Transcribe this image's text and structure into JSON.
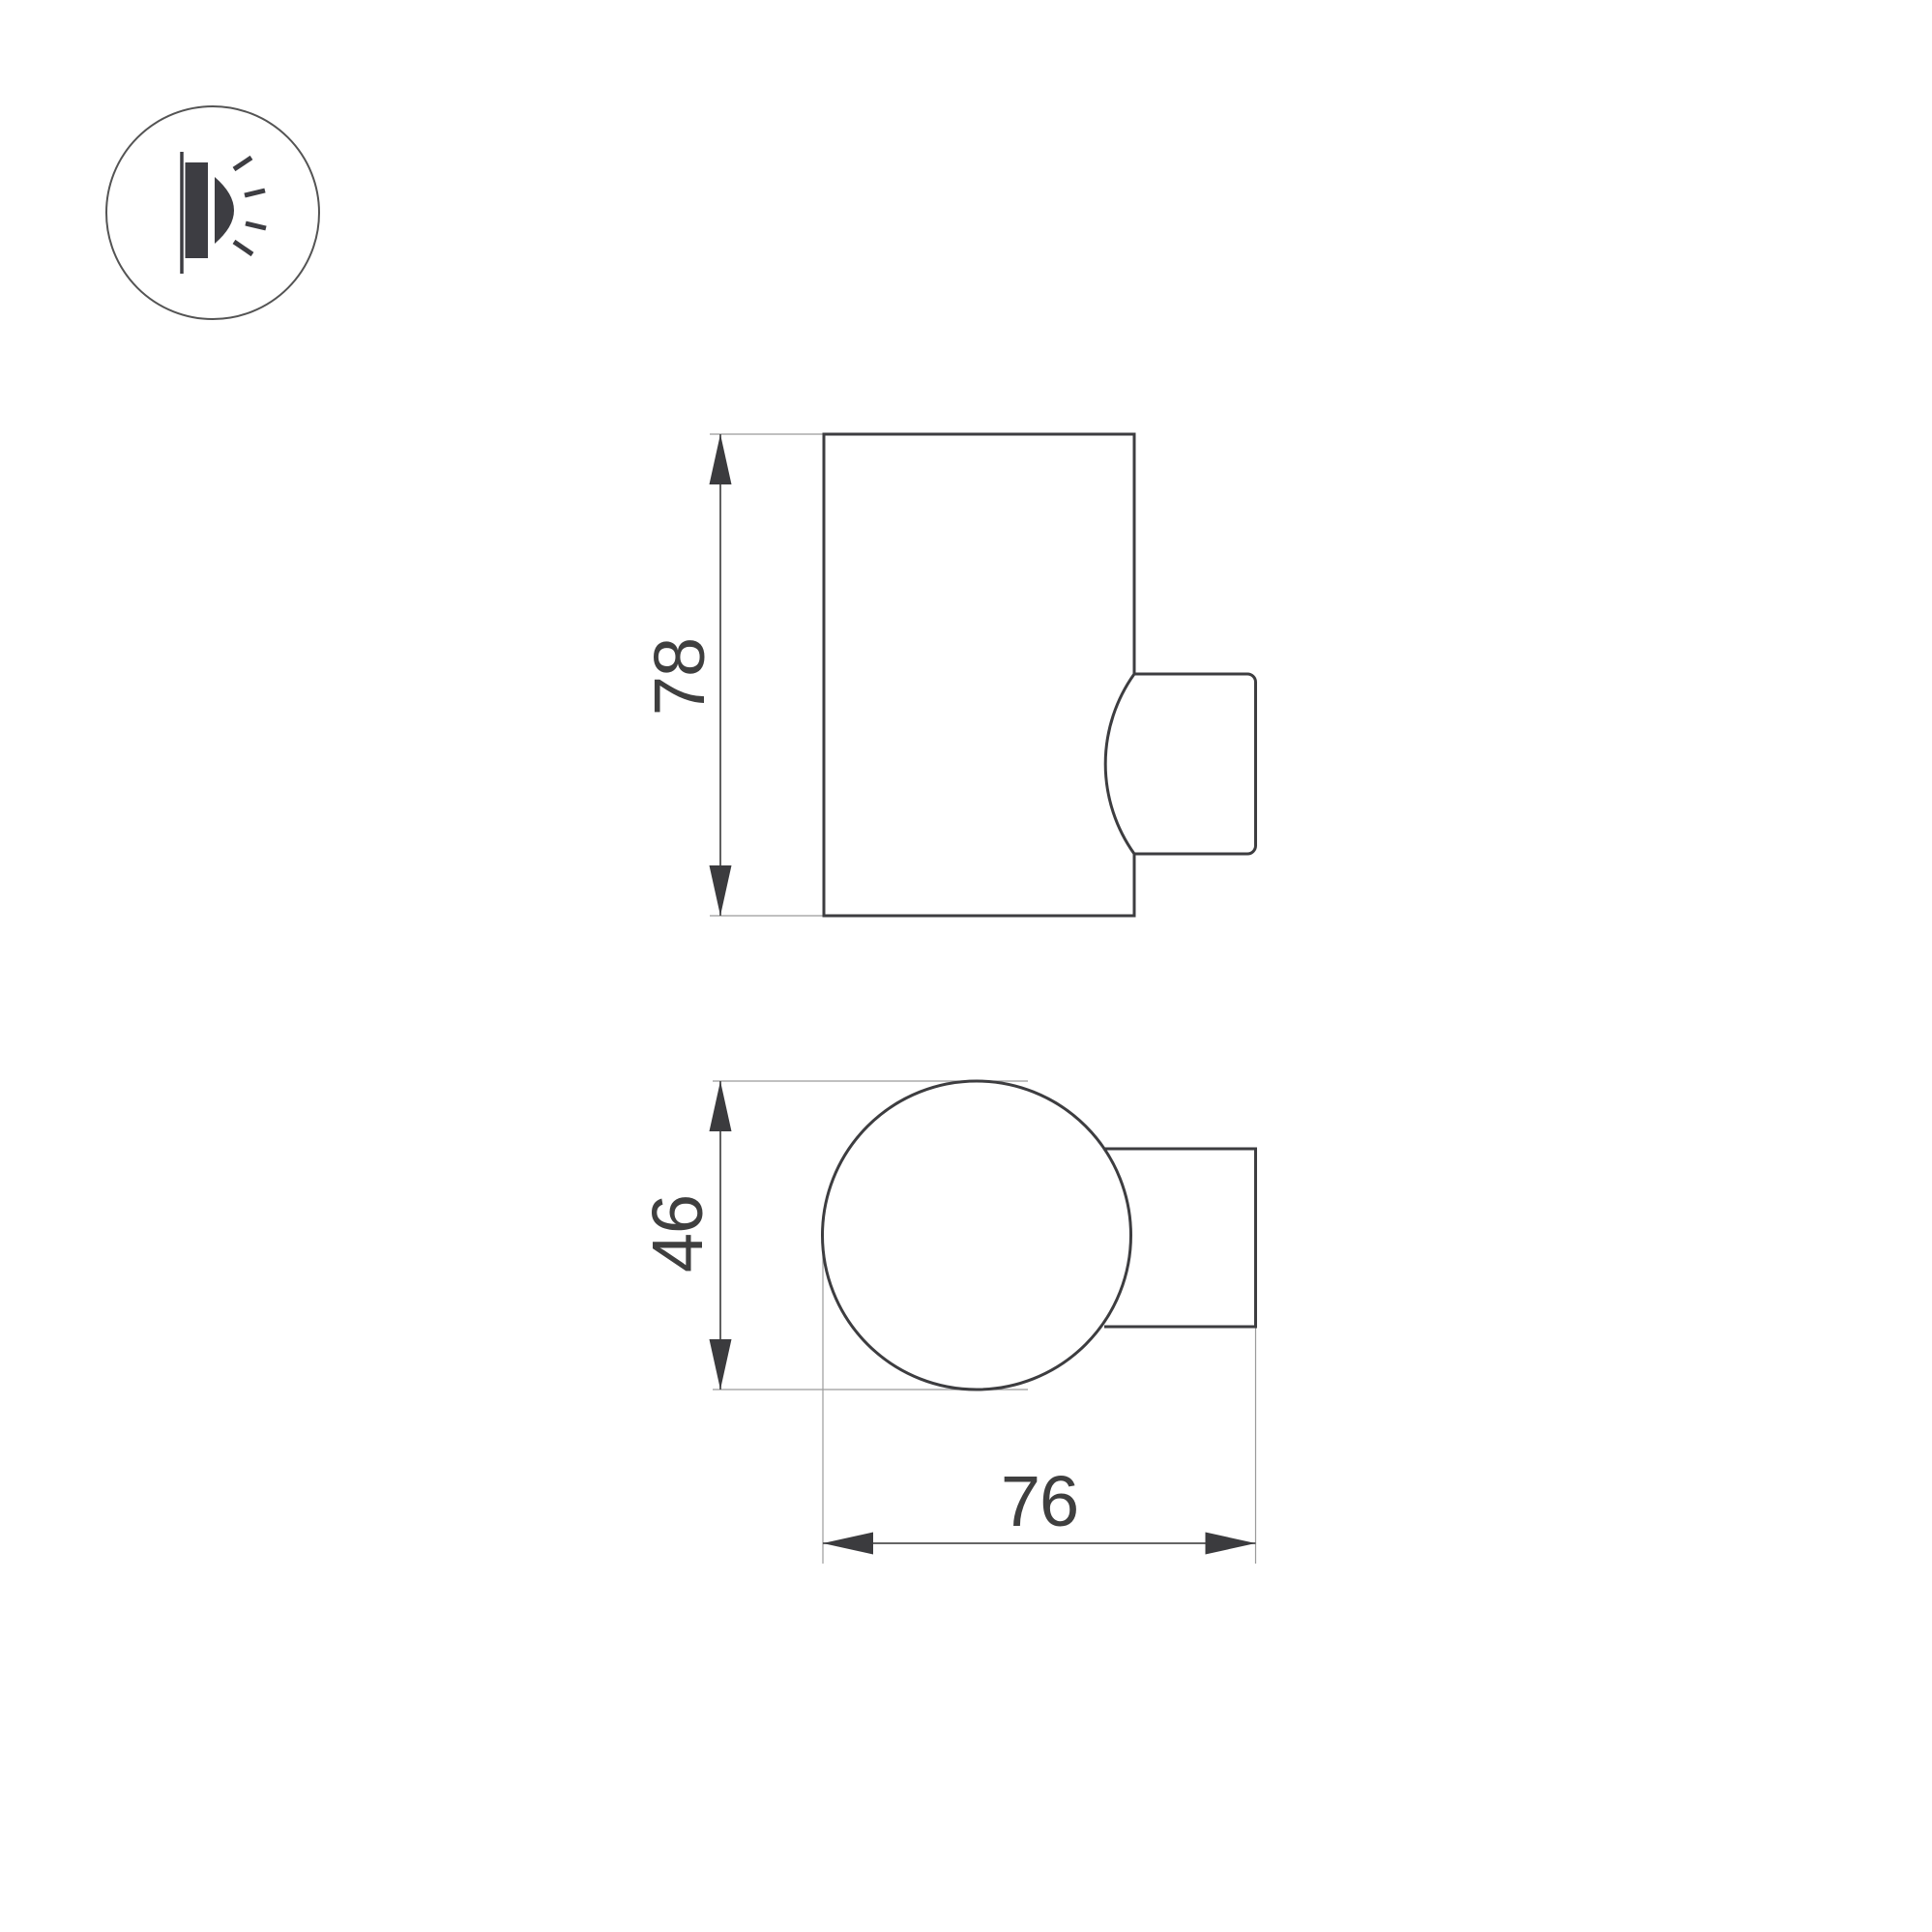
{
  "colors": {
    "background": "#ffffff",
    "outline": "#3d3d40",
    "dimension_line": "#4f4f4f",
    "extension_line": "#9b9b9b",
    "arrow_fill": "#3b3b3e",
    "label_text": "#3f3f3f",
    "icon_stroke": "#545454",
    "icon_fill": "#3d3d42"
  },
  "icon_badge": {
    "icon": "wall-lamp-side-glow-icon"
  },
  "dimensions": {
    "height": {
      "value": "78"
    },
    "diameter": {
      "value": "46"
    },
    "depth": {
      "value": "76"
    }
  }
}
